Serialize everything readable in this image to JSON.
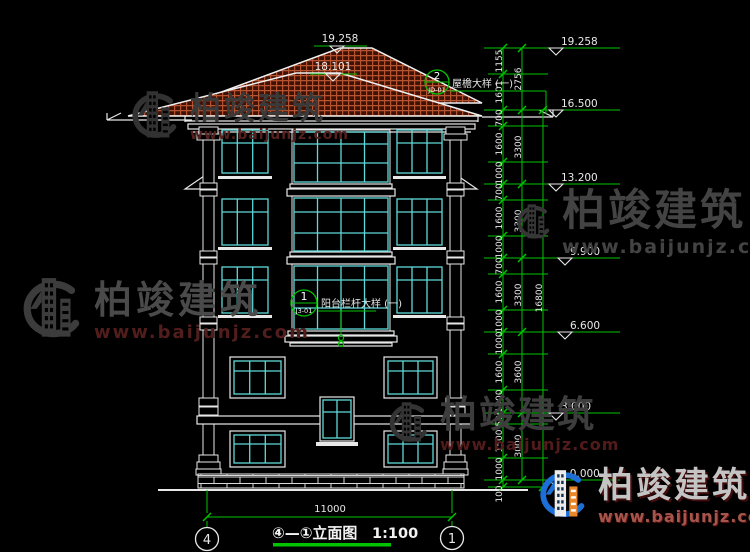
{
  "watermark": {
    "brand": "柏竣建筑",
    "url": "www.baijunjz.com"
  },
  "roof_marks": {
    "main_ridge": "19.258",
    "front_ridge": "18.101"
  },
  "callout_eave": {
    "num": "2",
    "ref": "JD-01",
    "label": "屋檐大样 (一)"
  },
  "callout_balcony": {
    "num": "1",
    "ref": "J3-01",
    "label": "阳台栏杆大样 (一)"
  },
  "right_dims": {
    "inner": [
      "1155",
      "1601",
      "700",
      "1600",
      "1000",
      "700",
      "1600",
      "1000",
      "700",
      "1600",
      "1000",
      "1000",
      "1600",
      "1000",
      "500",
      "1500",
      "1000",
      "100"
    ],
    "middle": [
      "2756",
      "3300",
      "3300",
      "3300",
      "3600",
      "3000"
    ],
    "overall": "16800"
  },
  "elevations": [
    "19.258",
    "16.500",
    "13.200",
    "9.900",
    "6.600",
    "3.000",
    "±0.000"
  ],
  "bottom": {
    "width_dim": "11000",
    "grid_left": "4",
    "grid_right": "1",
    "title": "④—①立面图",
    "scale": "1:100"
  }
}
